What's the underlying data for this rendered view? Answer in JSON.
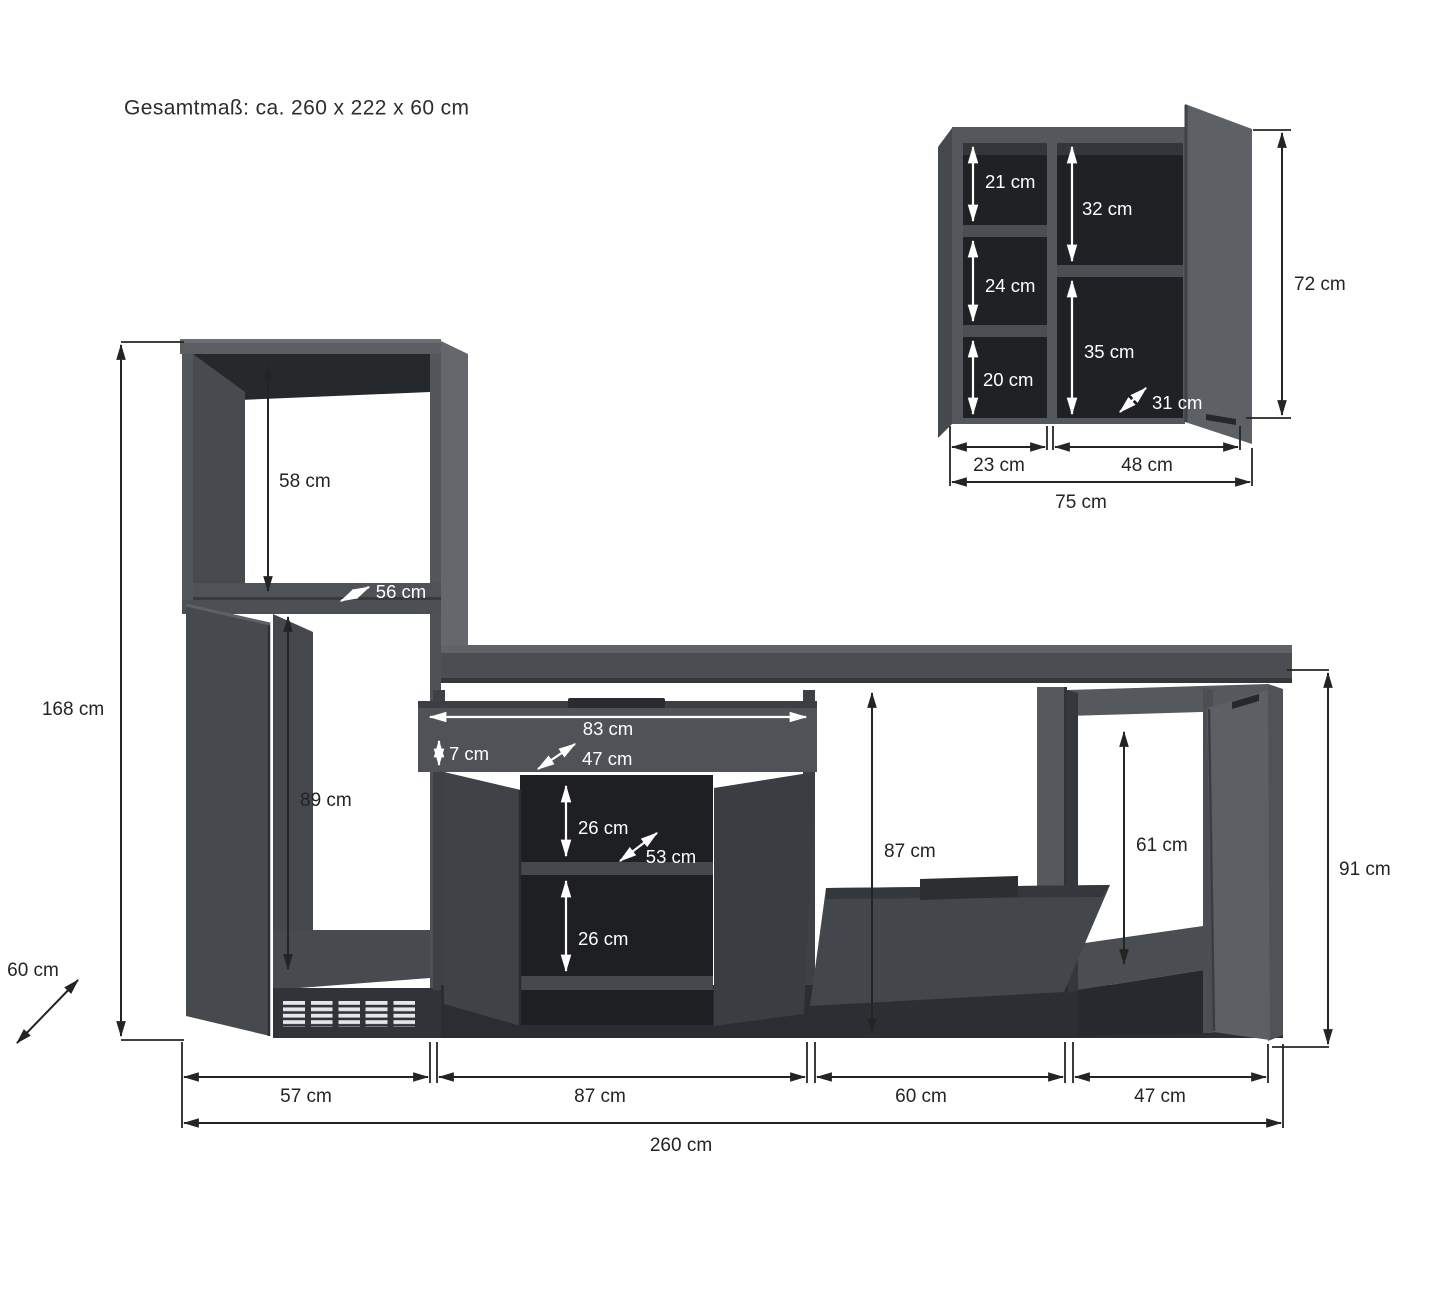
{
  "title": "Gesamtmaß: ca. 260 x 222 x 60 cm",
  "colors": {
    "background": "#ffffff",
    "cabinet_front": "#54575b",
    "cabinet_side_light": "#64676b",
    "cabinet_door_open": "#46494d",
    "interior_dark": "#1f2125",
    "worktop": "#4a4d51",
    "dimension_line": "#242424",
    "dimension_line_light": "#ffffff"
  },
  "wall_cabinet": {
    "inner_heights": {
      "top_left": "21 cm",
      "mid_left": "24 cm",
      "bottom_left": "20 cm",
      "top_right": "32 cm",
      "bottom_right": "35 cm"
    },
    "depth": "31 cm",
    "width_left": "23 cm",
    "width_right": "48 cm",
    "width_total": "75 cm",
    "height": "72 cm"
  },
  "main_unit": {
    "oven_compartment_height": "58 cm",
    "oven_compartment_depth": "56 cm",
    "lower_compartment_height": "89 cm",
    "height_left": "168 cm",
    "depth": "60 cm",
    "drawer_inner_width": "83 cm",
    "drawer_inner_height": "7 cm",
    "drawer_depth": "47 cm",
    "shelf_gap_upper": "26 cm",
    "shelf_depth": "53 cm",
    "shelf_gap_lower": "26 cm",
    "appliance_gap_height": "87 cm",
    "right_compartment_height": "61 cm",
    "height_right": "91 cm",
    "width_tall": "57 cm",
    "width_middle": "87 cm",
    "width_gap": "60 cm",
    "width_right": "47 cm",
    "width_total": "260 cm"
  }
}
